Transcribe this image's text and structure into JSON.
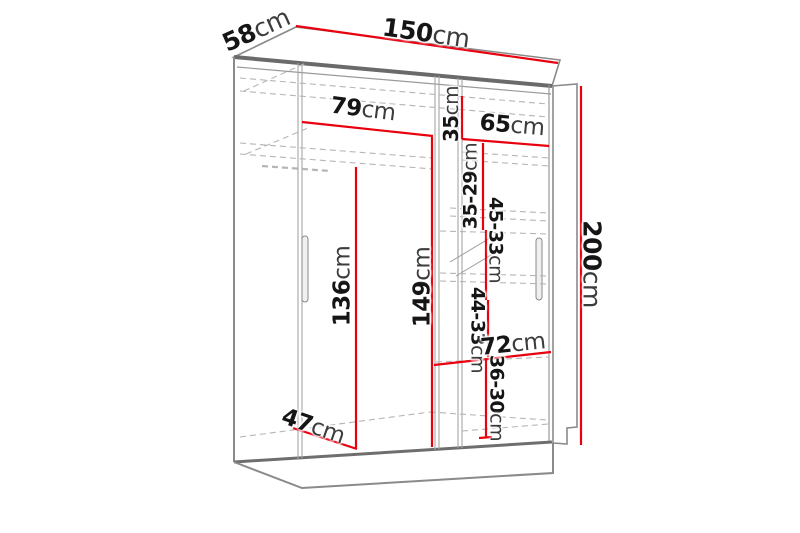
{
  "diagram": {
    "type": "furniture-dimension-drawing",
    "subject": "two-door sliding wardrobe with interior shelves",
    "unit": "cm",
    "colors": {
      "dimension_line": "#e8000e",
      "outline": "#8a8a8a",
      "text": "#151515",
      "background": "#ffffff"
    },
    "dimensions": {
      "width": {
        "value": "150",
        "unit": "cm"
      },
      "depth": {
        "value": "58",
        "unit": "cm"
      },
      "height": {
        "value": "200",
        "unit": "cm"
      },
      "upper_left_width": {
        "value": "79",
        "unit": "cm"
      },
      "top_right_height": {
        "value": "35",
        "unit": "cm"
      },
      "upper_right_width": {
        "value": "65",
        "unit": "cm"
      },
      "right_shelf_gap_1": {
        "value": "35-29",
        "unit": "cm"
      },
      "right_shelf_gap_2": {
        "value": "45-33",
        "unit": "cm"
      },
      "right_shelf_gap_3": {
        "value": "44-33",
        "unit": "cm"
      },
      "right_shelf_gap_4": {
        "value": "36-30",
        "unit": "cm"
      },
      "left_hanging_height": {
        "value": "136",
        "unit": "cm"
      },
      "center_interior_height": {
        "value": "149",
        "unit": "cm"
      },
      "lower_right_width": {
        "value": "72",
        "unit": "cm"
      },
      "interior_depth": {
        "value": "47",
        "unit": "cm"
      }
    }
  }
}
